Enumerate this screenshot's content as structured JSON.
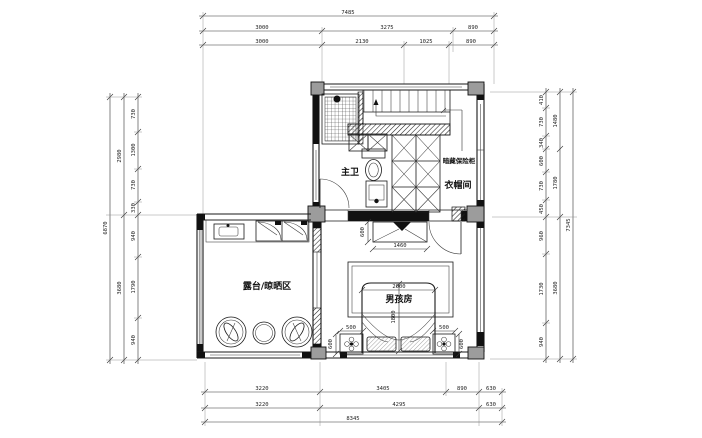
{
  "labels": {
    "master_bath": "主卫",
    "hidden_safe": "暗藏保险柜",
    "cloakroom": "衣帽间",
    "terrace": "露台/晾晒区",
    "boys_room": "男孩房"
  },
  "dimensions": {
    "top": {
      "total": "7485",
      "row2": [
        "3000",
        "3275",
        "890"
      ],
      "row3": [
        "3000",
        "2130",
        "1025",
        "890"
      ]
    },
    "bottom": {
      "row1": [
        "3220",
        "3405",
        "890",
        "630"
      ],
      "row2": [
        "3220",
        "4295",
        "630"
      ],
      "total": "8345"
    },
    "left": {
      "segments": [
        "730",
        "1300",
        "730",
        "330",
        "940",
        "1790",
        "940"
      ],
      "groups": [
        "2980",
        "3680"
      ],
      "total": "6870"
    },
    "right": {
      "segments": [
        "410",
        "730",
        "340",
        "600",
        "730",
        "450",
        "960",
        "1730",
        "940"
      ],
      "groups": [
        "1480",
        "1780",
        "3680"
      ],
      "total": "7345"
    },
    "furniture": {
      "bed_width": "2000",
      "bed_length": "1800",
      "desk_width": "1460",
      "desk_depth": "600",
      "nightstand_left_width": "500",
      "nightstand_right_width": "500",
      "nightstand_left_depth": "600",
      "nightstand_right_depth": "600"
    }
  }
}
